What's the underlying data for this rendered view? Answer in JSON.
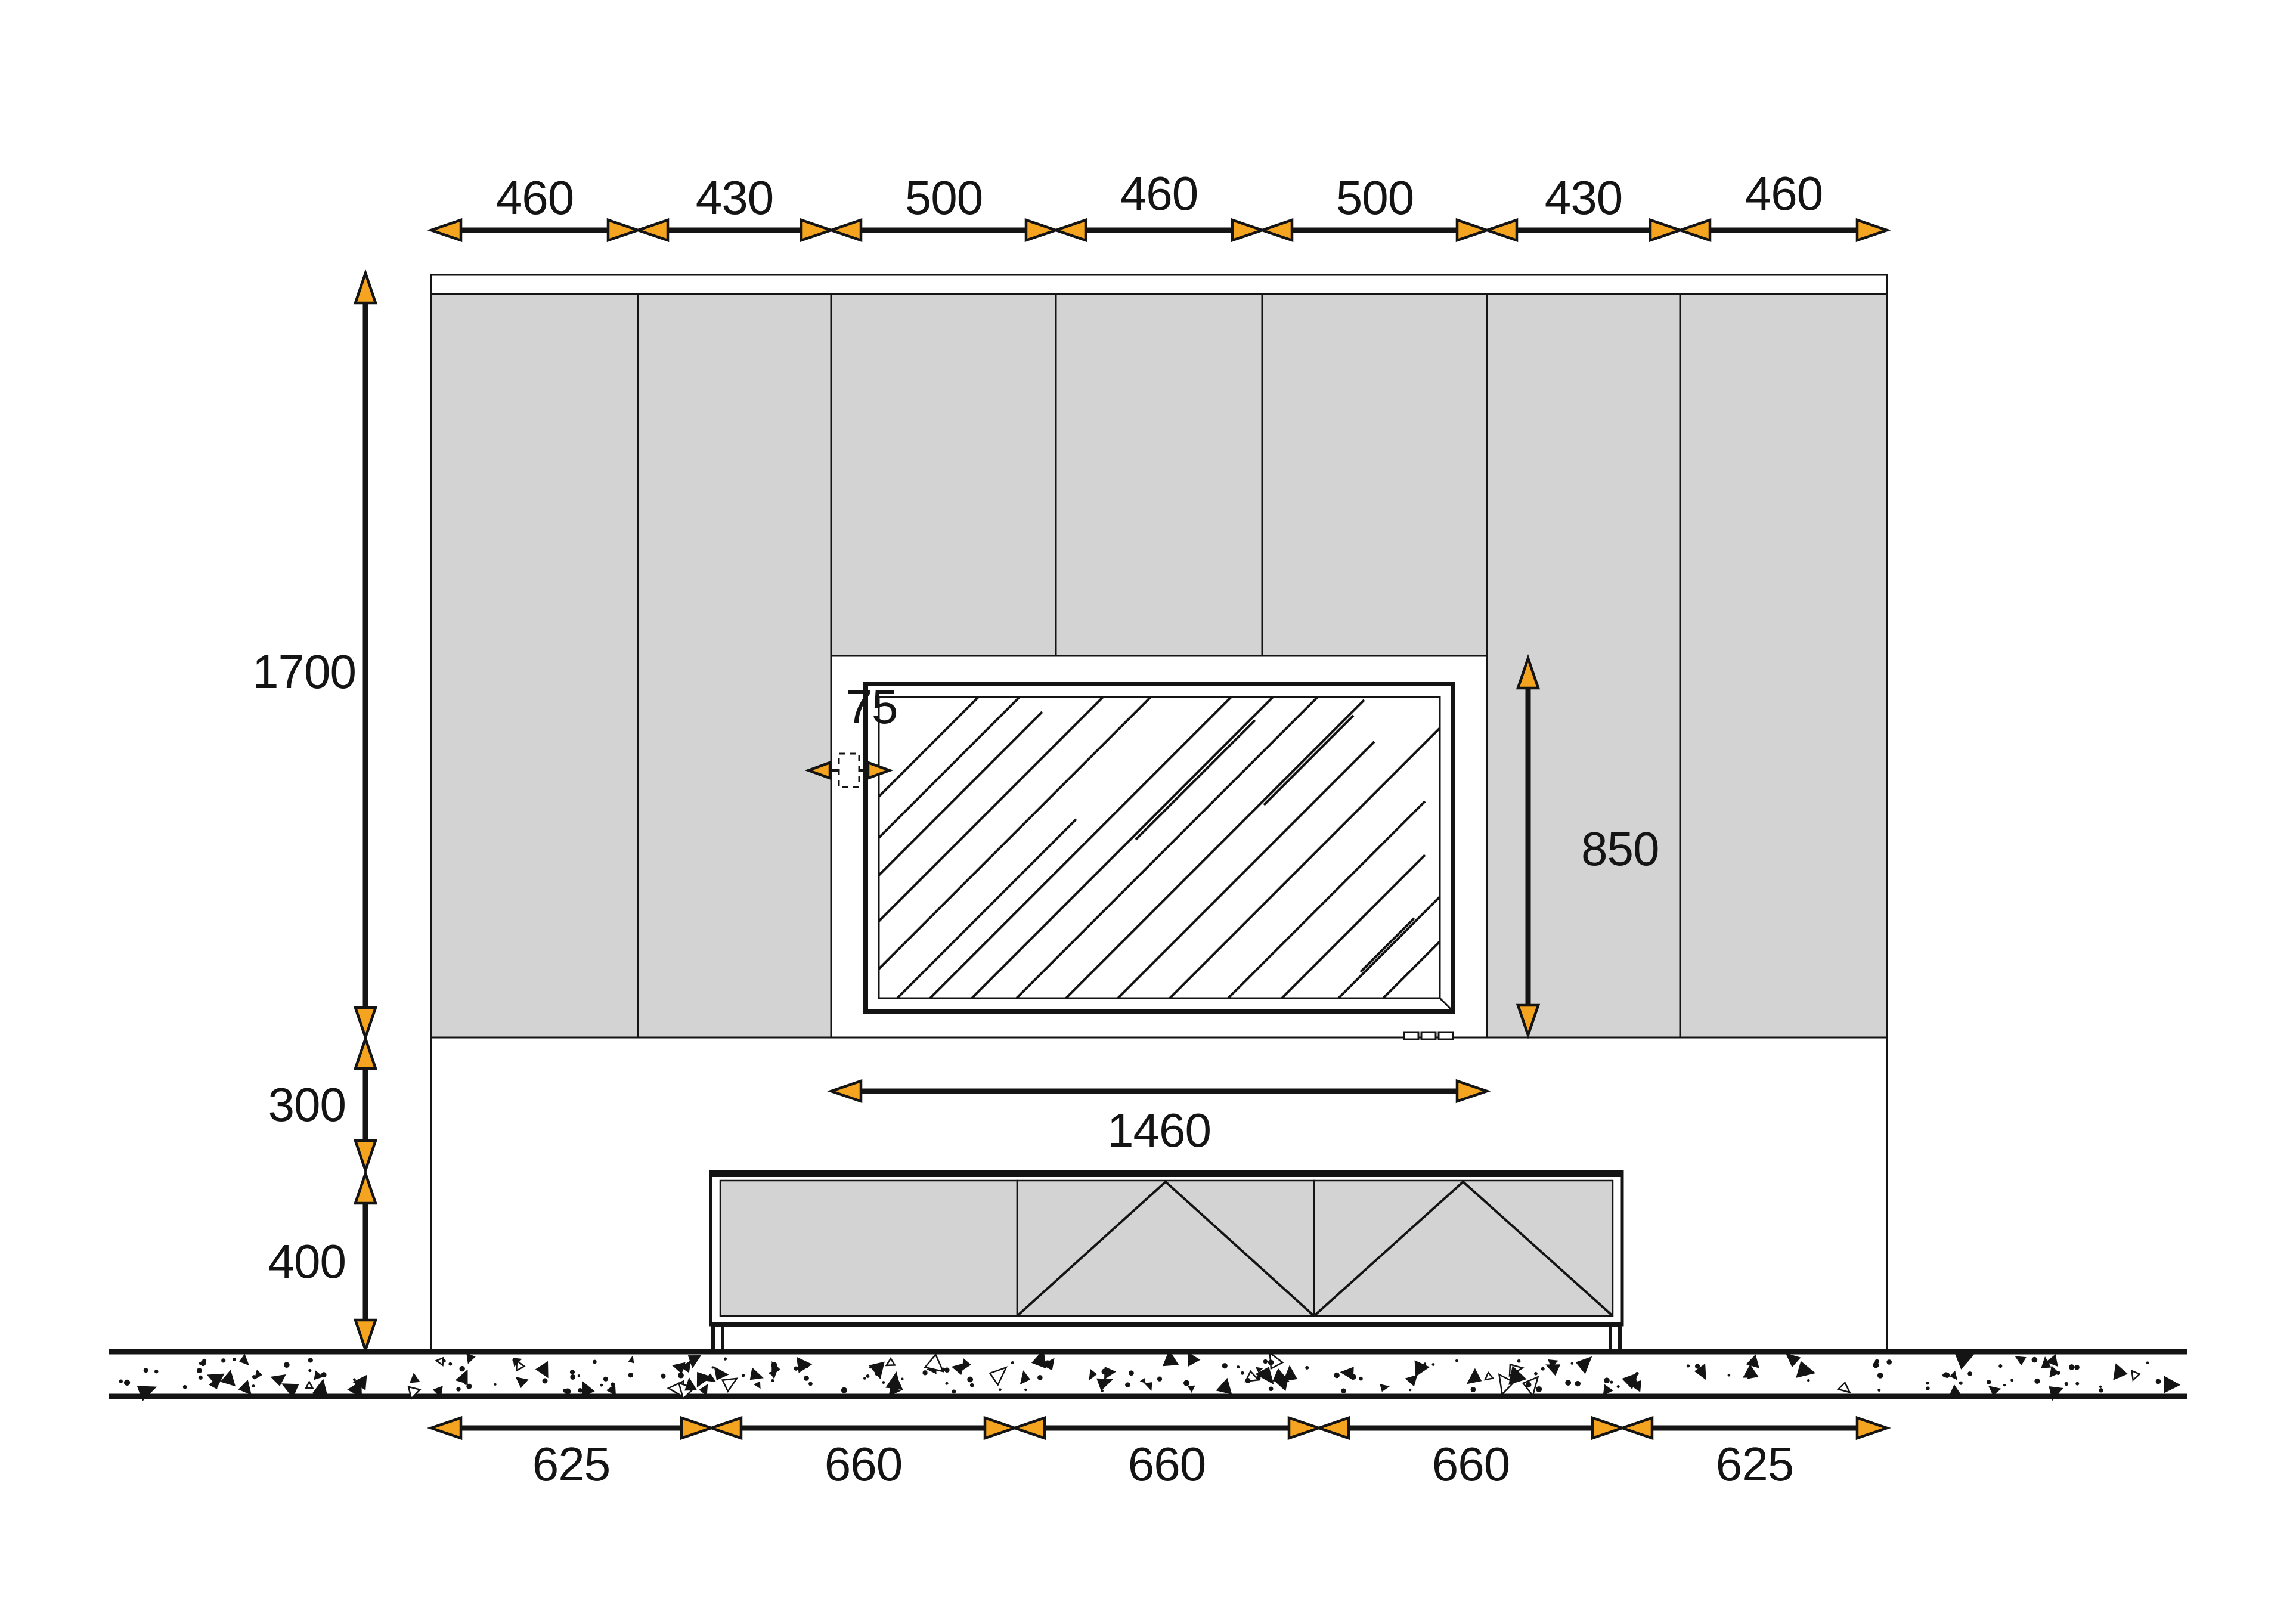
{
  "dimensions": {
    "top": {
      "labels": [
        "460",
        "430",
        "500",
        "460",
        "500",
        "430",
        "460"
      ]
    },
    "left": {
      "labels": [
        "1700",
        "300",
        "400"
      ]
    },
    "niche": {
      "width": "1460",
      "height": "850",
      "gap": "75"
    },
    "bottom": {
      "labels": [
        "625",
        "660",
        "660",
        "660",
        "625"
      ]
    }
  },
  "colors": {
    "arrow_fill": "#F5A41F",
    "line": "#141414",
    "panel_gray": "#D3D3D3",
    "background": "#FFFFFF"
  }
}
